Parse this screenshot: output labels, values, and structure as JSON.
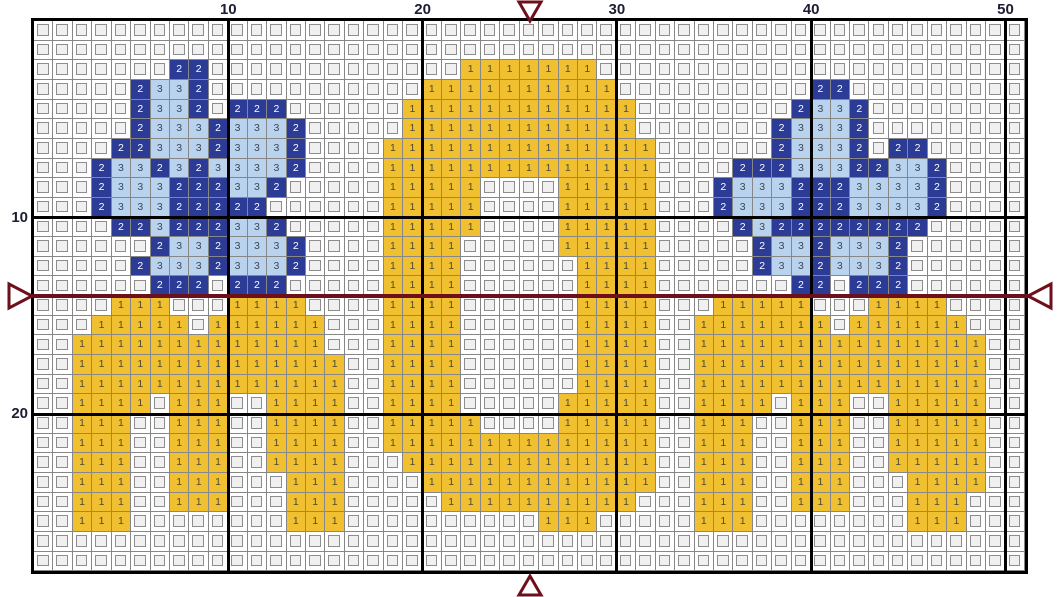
{
  "chart": {
    "columns": 51,
    "rows": 28,
    "bold_every": 10,
    "top_ruler": [
      {
        "text": "10",
        "col": 10
      },
      {
        "text": "20",
        "col": 20
      },
      {
        "text": "30",
        "col": 30
      },
      {
        "text": "40",
        "col": 40
      },
      {
        "text": "50",
        "col": 50
      }
    ],
    "left_ruler": [
      {
        "text": "10",
        "row": 10
      },
      {
        "text": "20",
        "row": 20
      }
    ],
    "palette": {
      "1": {
        "symbol": "1",
        "fill": "#F0C030",
        "text_color": "#4d4a33",
        "name": "yellow"
      },
      "2": {
        "symbol": "2",
        "fill": "#2C3B95",
        "text_color": "#ffffff",
        "name": "dark-blue"
      },
      "3": {
        "symbol": "3",
        "fill": "#B9D3EE",
        "text_color": "#3e4754",
        "name": "light-blue"
      },
      "empty": {
        "inner_fill": "#f0f0f0",
        "inner_border": "#8d8d8d"
      }
    },
    "grid_colors": {
      "thin_line": "#878787",
      "bold_line": "#000000",
      "background": "#ffffff"
    },
    "center_markers": {
      "color": "#6E101B",
      "center_col": 26,
      "center_row_boundary": 14,
      "top": "triangle-down",
      "bottom": "triangle-up",
      "left": "triangle-right",
      "right": "triangle-left",
      "horizontal_line": true,
      "vertical_line": false
    },
    "pattern": [
      "...................................................",
      "...................................................",
      ".......22.............1111111......................",
      ".....2332...........1111111111..........22.........",
      ".....2332.222......111111111111........2332........",
      ".....233323332.....111111111111.......23332........",
      "....2233323332....11111111111111......23332.22.....",
      "...23323233332....11111111111111....22233322332....",
      "...2333222332.....11111....11111...233322233332....",
      "...233322222......11111....11111...233322233332....",
      "....223222332.....11111....11111....2322222222.....",
      "......23323332....1111.....11111.....23323332......",
      ".....233323332....1111......1111.....23323332......",
      "......222.222.....1111......1111.......22.222......",
      "....111...1111....1111......1111...11111...1111....",
      "...11111.111111...1111......1111..1111111.111111...",
      "..1111111111111...1111......1111..111111111111111..",
      "..11111111111111..1111......1111..111111111111111..",
      "..11111111111111..1111......1111..111111111111111..",
      "..1111.111..1111..1111.....11111..1111.111..11111..",
      "..111..111..1111..11111....11111..111..111..11111..",
      "..111..111..1111..11111111111111..111..111..11111..",
      "..111..111..1111...1111111111111..111..111..11111..",
      "..111..111...111....111111111111..111..111...1111..",
      "..111..111...111.....1111111111...111..111...111...",
      "..111........111..........111.....111........111...",
      "...................................................",
      "..................................................."
    ]
  }
}
